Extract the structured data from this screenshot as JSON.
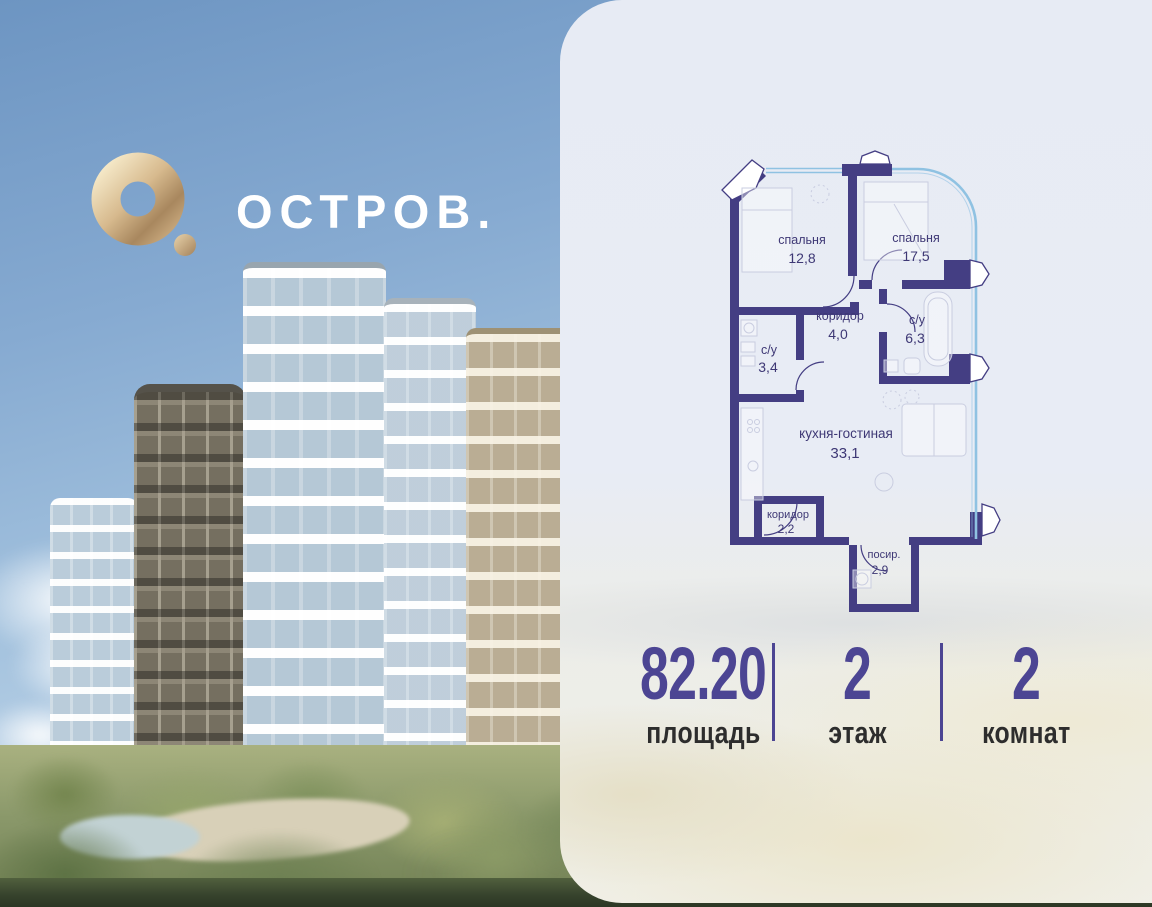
{
  "logo": {
    "brand": "ОСТРОВ."
  },
  "plan": {
    "rooms": [
      {
        "name": "спальня",
        "area": "12,8"
      },
      {
        "name": "спальня",
        "area": "17,5"
      },
      {
        "name": "коридор",
        "area": "4,0"
      },
      {
        "name": "с/у",
        "area": "6,3"
      },
      {
        "name": "с/у",
        "area": "3,4"
      },
      {
        "name": "кухня-гостиная",
        "area": "33,1"
      },
      {
        "name": "коридор",
        "area": "2,2"
      },
      {
        "name": "посир.",
        "area": "2,9"
      }
    ]
  },
  "stats": {
    "area": {
      "value": "82.20",
      "label": "площадь"
    },
    "floor": {
      "value": "2",
      "label": "этаж"
    },
    "rooms": {
      "value": "2",
      "label": "комнат"
    }
  },
  "colors": {
    "accent_purple": "#4c4593",
    "plan_wall": "#443e83",
    "plan_glazing": "#8fc2e2",
    "logo_gold": "#cbab7d",
    "card_background": "#e9edf4"
  }
}
